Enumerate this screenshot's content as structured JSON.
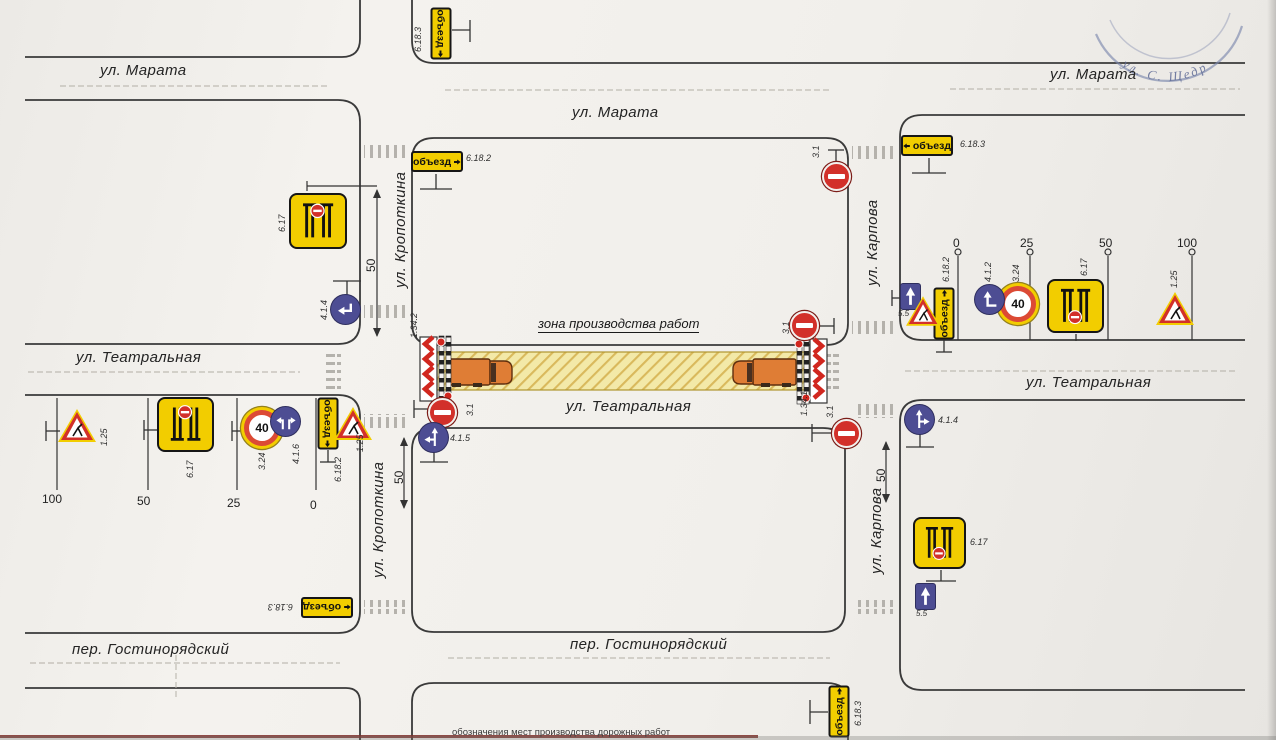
{
  "title_stamp": "ул. С. Щедр",
  "work_zone": {
    "label": "зона производства работ"
  },
  "streets": {
    "marata": "ул. Марата",
    "teatralnaya": "ул. Театральная",
    "kropotkina": "ул. Кропоткина",
    "karpova": "ул. Карпова",
    "gostinoryadsky": "пер. Гостинорядский"
  },
  "signs": {
    "detour_text": "объезд",
    "speed_value": "40",
    "s6_17": "6.17",
    "s6_18_2": "6.18.2",
    "s6_18_3": "6.18.3",
    "s1_25": "1.25",
    "s3_24": "3.24",
    "s3_1": "3.1",
    "s4_1_2": "4.1.2",
    "s4_1_4": "4.1.4",
    "s4_1_5": "4.1.5",
    "s4_1_6": "4.1.6",
    "s5_5": "5.5",
    "s1_34_1": "1.34.1",
    "s1_34_2": "1.34.2"
  },
  "rulers": {
    "left": [
      "100",
      "50",
      "25",
      "0"
    ],
    "right": [
      "0",
      "25",
      "50",
      "100"
    ]
  },
  "dimensions": {
    "kropotkina_north": "50",
    "kropotkina_south": "50",
    "karpova_south": "50"
  },
  "caption": "обозначения мест производства дорожных работ",
  "colors": {
    "sign_yellow": "#f2cd00",
    "sign_blue": "#4d4d93",
    "sign_red": "#d2302a",
    "work_zone_fill": "#f3e9a8",
    "road_line": "#3a3a3a"
  }
}
